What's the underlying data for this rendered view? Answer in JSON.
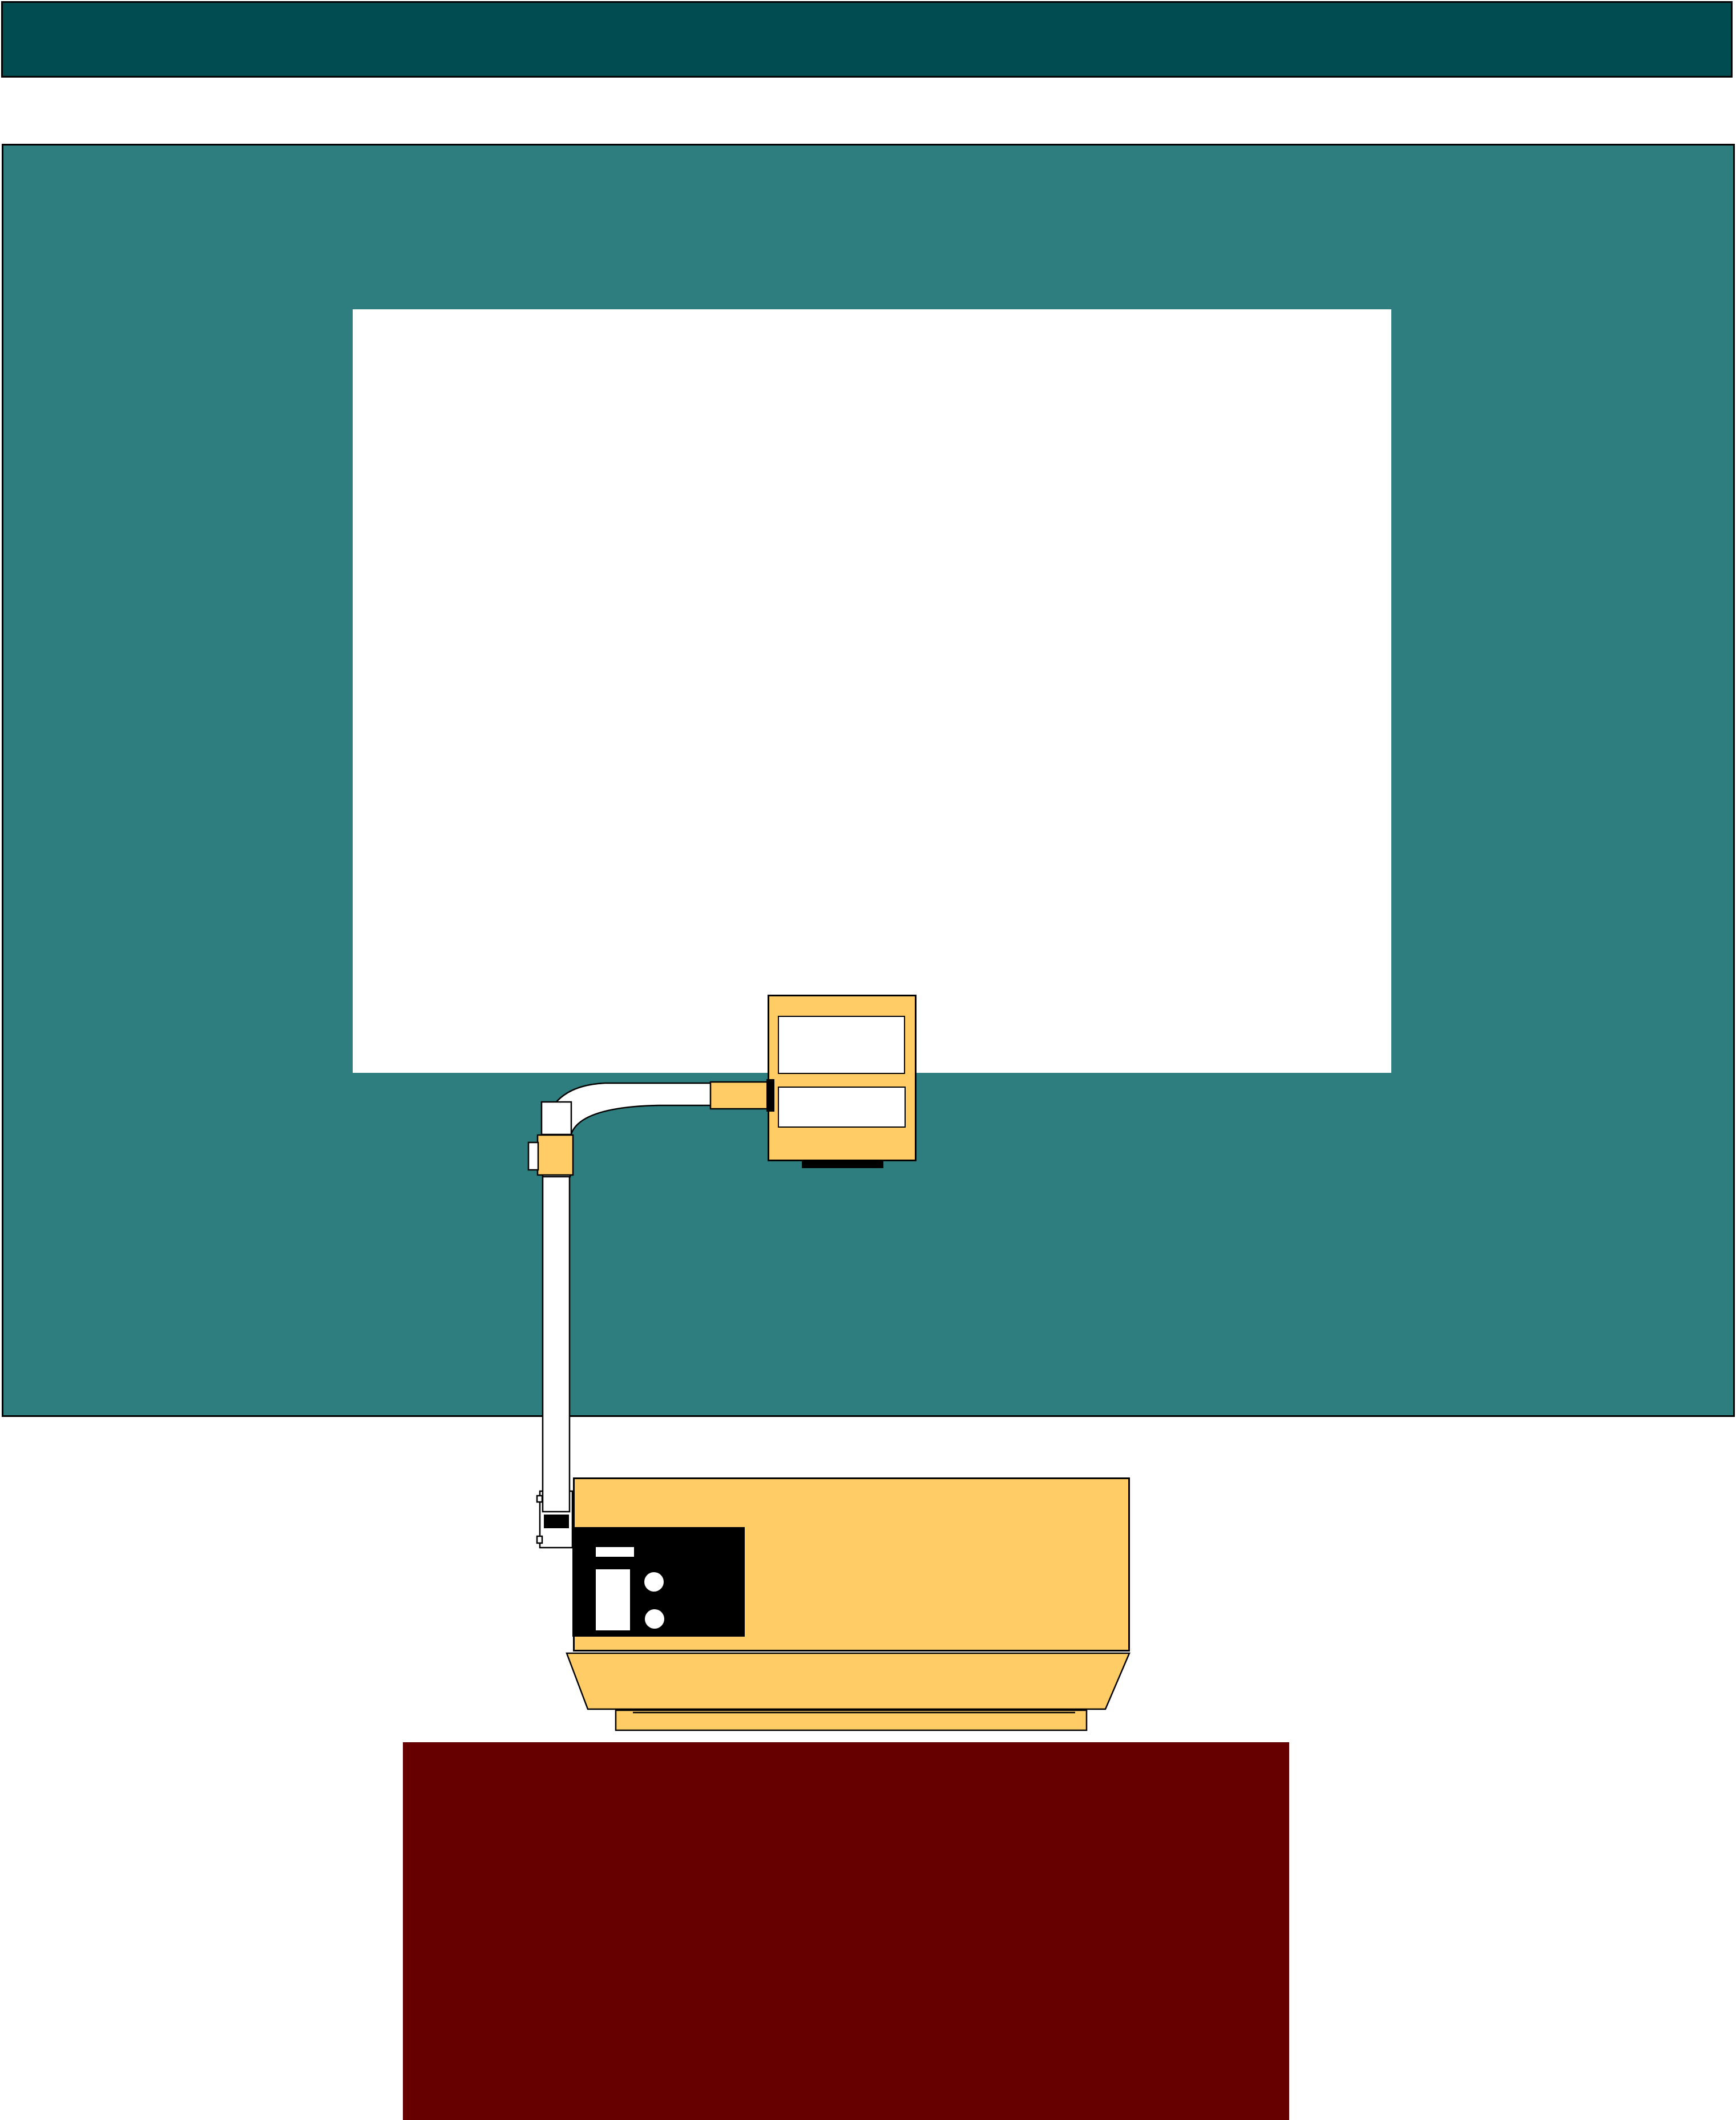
{
  "scene": {
    "description": "Flat clip-art illustration of an overhead projector standing on a dark red table, with its mirror head arm raised toward a blank white projection screen mounted on a teal wall beneath a dark teal ceiling band. No text is present in the image.",
    "elements": {
      "top_band": "dark teal horizontal band across the top of the wall",
      "wall": "large teal wall panel with thin black outline",
      "projection_screen": "blank white rectangular projection screen",
      "projector_head": "yellow mirror head with two white windows",
      "projector_arm": "white bent tube arm with elbow joint, yellow clamp and vertical post",
      "projector_body": "yellow projector base unit with black control panel",
      "control_panel": "black panel with white slot, slider and two round knobs",
      "table": "dark red table supporting the projector"
    }
  },
  "colors": {
    "background": "#FFFFFF",
    "band": "#004C51",
    "wall": "#2F7E7F",
    "screen": "#FFFFFF",
    "machine": "#FFCC66",
    "panel": "#000000",
    "arm": "#FFFFFF",
    "table": "#660000",
    "outline": "#000000"
  }
}
